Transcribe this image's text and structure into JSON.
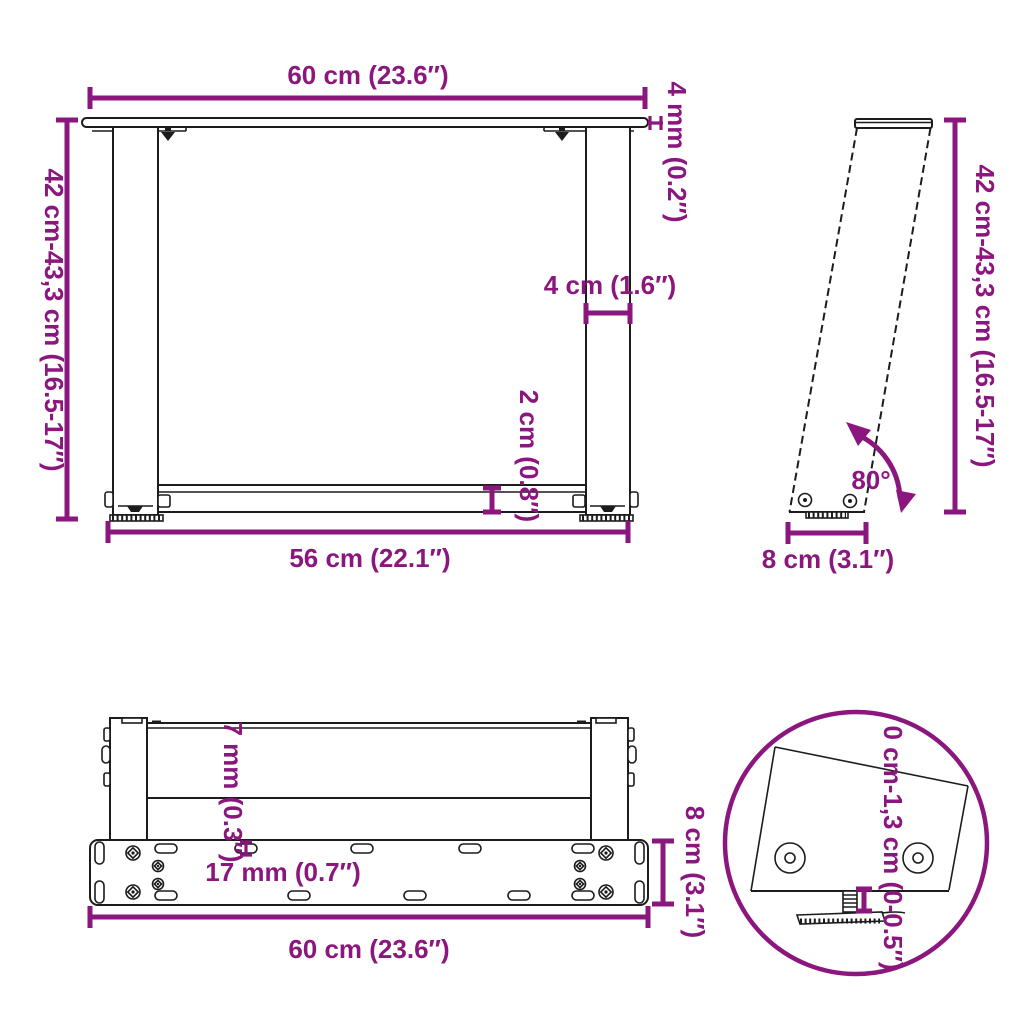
{
  "colors": {
    "accent": "#8B177E",
    "line": "#1C1C1C",
    "background": "#FFFFFF"
  },
  "views": {
    "front": {
      "width_top": "60 cm (23.6″)",
      "height_left": "42 cm-43,3 cm (16.5-17″)",
      "top_plate_thickness": "4 mm (0.2″)",
      "leg_width": "4 cm (1.6″)",
      "cross_bar_height": "2 cm (0.8″)",
      "width_between_feet": "56 cm (22.1″)"
    },
    "side": {
      "height_right": "42 cm-43,3 cm (16.5-17″)",
      "leg_angle": "80°",
      "foot_depth": "8 cm (3.1″)"
    },
    "plan": {
      "bar_offset": "7 mm (0.3″)",
      "hole_spacing": "17 mm (0.7″)",
      "plate_depth": "8 cm (3.1″)",
      "plate_width": "60 cm (23.6″)"
    },
    "detail": {
      "foot_adjustment_range": "0 cm-1,3 cm (0-0.5″)"
    }
  }
}
